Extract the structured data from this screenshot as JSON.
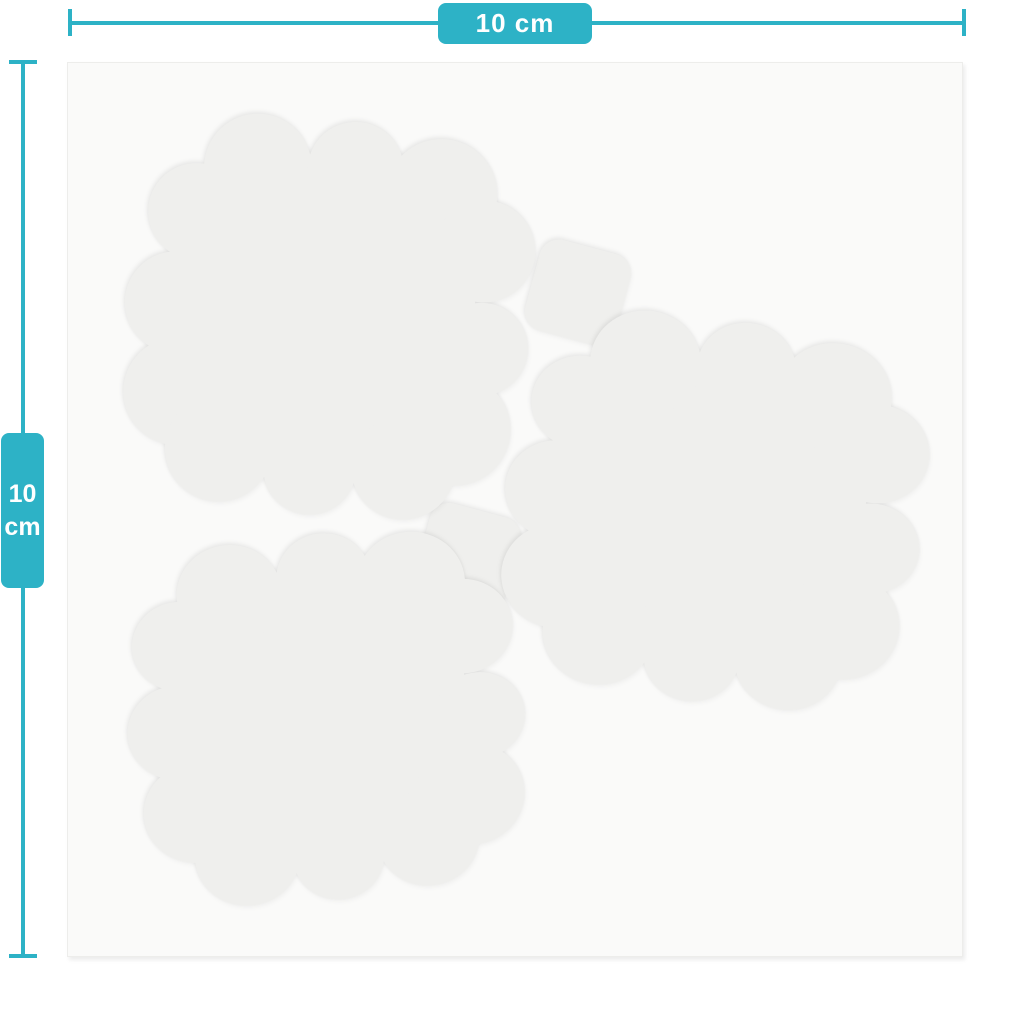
{
  "labels": {
    "horizontal": "10 cm",
    "vertical_value": "10",
    "vertical_unit": "cm"
  },
  "colors": {
    "accent": "#2db2c6",
    "label_text": "#ffffff",
    "page_background": "#ffffff",
    "panel_background": "#fafaf9",
    "pad_fill": "#efefed"
  },
  "shapes": {
    "pad_count": 3,
    "tab_count": 2,
    "description": "Three scallop-edged square gel pads on a backing sheet with two small square tabs between them"
  }
}
